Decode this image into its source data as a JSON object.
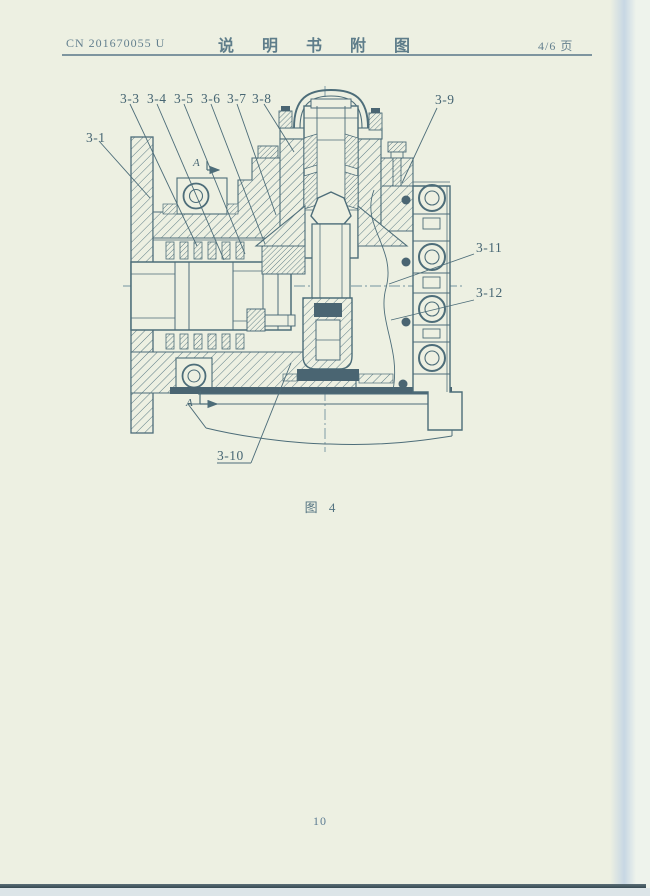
{
  "header": {
    "patent_number": "CN 201670055 U",
    "title": "说 明 书 附 图",
    "page_indicator": "4/6 页"
  },
  "figure": {
    "caption": "图 4",
    "section_marker_top": "A",
    "section_marker_bottom": "A",
    "callouts": [
      {
        "id": "3-1"
      },
      {
        "id": "3-3"
      },
      {
        "id": "3-4"
      },
      {
        "id": "3-5"
      },
      {
        "id": "3-6"
      },
      {
        "id": "3-7"
      },
      {
        "id": "3-8"
      },
      {
        "id": "3-9"
      },
      {
        "id": "3-10"
      },
      {
        "id": "3-11"
      },
      {
        "id": "3-12"
      }
    ]
  },
  "footer": {
    "page_number": "10"
  },
  "colors": {
    "paper": "#edf0e2",
    "ink": "#4d6d79",
    "ink_dark": "#4a6572",
    "hatch": "#5b7b85",
    "centerline": "#7494a0",
    "header_text": "#5e7d8a",
    "edge_shadow": "#c7d7e4",
    "bottom_edge": "#384b53"
  }
}
